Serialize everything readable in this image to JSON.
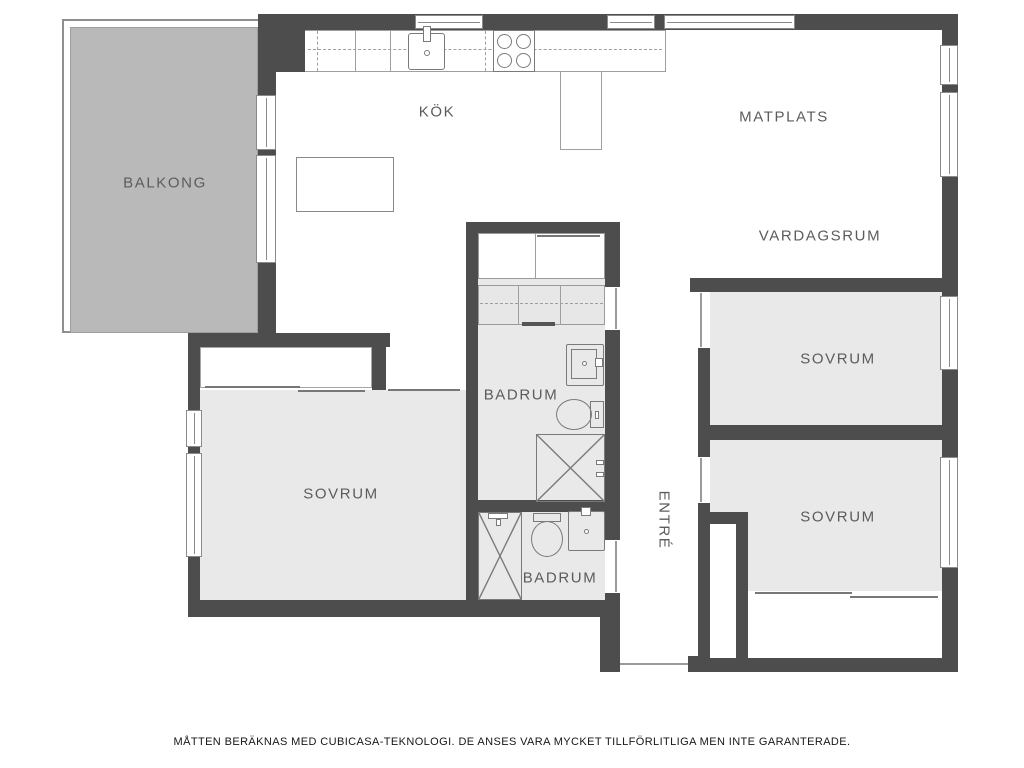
{
  "rooms": {
    "balcony": {
      "label": "BALKONG"
    },
    "kitchen": {
      "label": "KÖK"
    },
    "dining": {
      "label": "MATPLATS"
    },
    "living_room": {
      "label": "VARDAGSRUM"
    },
    "bedroom_left": {
      "label": "SOVRUM"
    },
    "bedroom_top_right": {
      "label": "SOVRUM"
    },
    "bedroom_bottom_right": {
      "label": "SOVRUM"
    },
    "bathroom_main": {
      "label": "BADRUM"
    },
    "bathroom_second": {
      "label": "BADRUM"
    },
    "entry": {
      "label": "ENTRÉ"
    }
  },
  "footer": {
    "disclaimer": "MÅTTEN BERÄKNAS MED CUBICASA-TEKNOLOGI. DE ANSES VARA MYCKET TILLFÖRLITLIGA MEN INTE GARANTERADE."
  },
  "colors": {
    "wall": "#4d4d4d",
    "room_fill": "#e9e9e9",
    "balcony_fill": "#b9b9b9",
    "fixture_outline": "#7a7a7a",
    "label_text": "#5c5c5c",
    "window_frame": "#8a8a8a"
  }
}
